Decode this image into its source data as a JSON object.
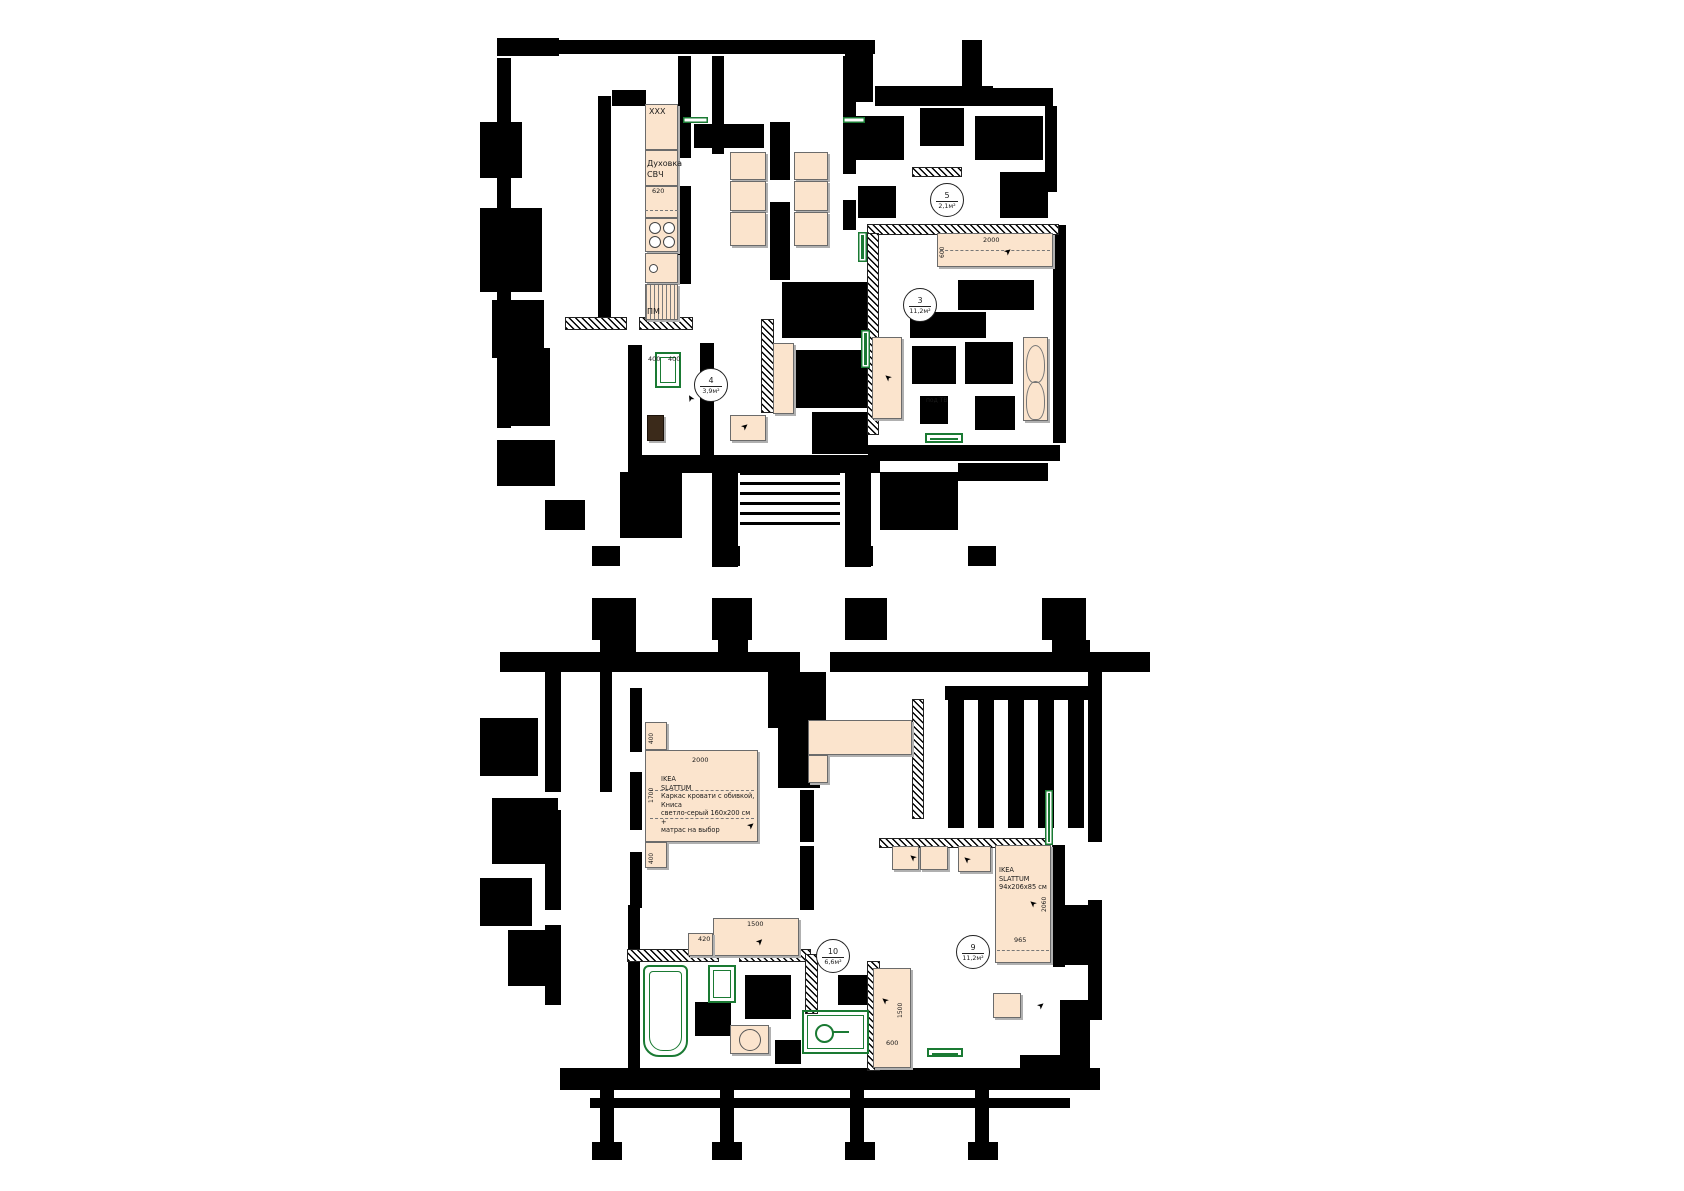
{
  "colors": {
    "wall": "#000000",
    "furniture_fill": "#fbe4cd",
    "furniture_border": "#6b6b6b",
    "green": "#1a7a33",
    "background": "#ffffff"
  },
  "kitchen": {
    "upper_cabinet": "XXX",
    "oven_line1": "Духовка",
    "oven_line2": "СВЧ",
    "counter_dim": "620",
    "dishwasher": "ПМ"
  },
  "room_markers": [
    {
      "n": "5",
      "a": "2,1м²",
      "x": 947,
      "y": 200
    },
    {
      "n": "3",
      "a": "11,2м²",
      "x": 920,
      "y": 305
    },
    {
      "n": "4",
      "a": "3,9м²",
      "x": 711,
      "y": 385
    },
    {
      "n": "10",
      "a": "6,6м²",
      "x": 833,
      "y": 956
    },
    {
      "n": "9",
      "a": "11,2м²",
      "x": 973,
      "y": 952
    }
  ],
  "labels": [
    {
      "t": "XXX",
      "x": 649,
      "y": 108,
      "s": 8
    },
    {
      "t": "Духовка",
      "x": 647,
      "y": 160,
      "s": 8
    },
    {
      "t": "СВЧ",
      "x": 647,
      "y": 171,
      "s": 8
    },
    {
      "t": "620",
      "x": 652,
      "y": 188,
      "s": 6.5
    },
    {
      "t": "ПМ",
      "x": 647,
      "y": 308,
      "s": 8
    },
    {
      "t": "400",
      "x": 648,
      "y": 356,
      "s": 6.5
    },
    {
      "t": "400",
      "x": 668,
      "y": 356,
      "s": 6.5
    },
    {
      "t": "2000",
      "x": 983,
      "y": 237,
      "s": 6.5
    },
    {
      "t": "600",
      "x": 940,
      "y": 258,
      "s": 6,
      "v": 1
    },
    {
      "t": "под ТВ",
      "x": 926,
      "y": 398,
      "s": 6
    },
    {
      "t": "2000",
      "x": 692,
      "y": 757,
      "s": 6.5
    },
    {
      "t": "1700",
      "x": 649,
      "y": 803,
      "s": 6,
      "v": 1
    },
    {
      "t": "400",
      "x": 649,
      "y": 744,
      "s": 5.8,
      "v": 1
    },
    {
      "t": "400",
      "x": 649,
      "y": 864,
      "s": 5.8,
      "v": 1
    },
    {
      "t": "1500",
      "x": 747,
      "y": 921,
      "s": 6.5
    },
    {
      "t": "420",
      "x": 698,
      "y": 936,
      "s": 6.5
    },
    {
      "t": "2060",
      "x": 1042,
      "y": 912,
      "s": 6,
      "v": 1
    },
    {
      "t": "965",
      "x": 1014,
      "y": 937,
      "s": 6.5
    },
    {
      "t": "1500",
      "x": 898,
      "y": 1018,
      "s": 6,
      "v": 1
    },
    {
      "t": "600",
      "x": 886,
      "y": 1040,
      "s": 6.5
    }
  ],
  "notes": [
    {
      "x": 661,
      "y": 775,
      "w": 95,
      "lines": [
        "IKEA",
        "SLATTUM",
        "Каркас кровати с обивкой, Книса",
        "светло-серый 160x200 см +",
        "матрас на выбор"
      ]
    },
    {
      "x": 999,
      "y": 866,
      "w": 52,
      "lines": [
        "IKEA",
        "SLATTUM",
        "94x206x85 см"
      ]
    }
  ],
  "furniture": [
    {
      "k": "cab",
      "n": "kitchen-upper-cabinet",
      "x": 645,
      "y": 104,
      "w": 33,
      "h": 46
    },
    {
      "k": "cab",
      "n": "kitchen-oven-cabinet",
      "x": 645,
      "y": 150,
      "w": 33,
      "h": 36
    },
    {
      "k": "cab",
      "n": "kitchen-counter",
      "x": 645,
      "y": 186,
      "w": 33,
      "h": 32
    },
    {
      "k": "stove",
      "n": "kitchen-stove",
      "x": 645,
      "y": 218,
      "w": 33,
      "h": 34
    },
    {
      "k": "sink",
      "n": "kitchen-sink",
      "x": 645,
      "y": 253,
      "w": 33,
      "h": 30
    },
    {
      "k": "dw",
      "n": "kitchen-dishwasher",
      "x": 645,
      "y": 284,
      "w": 33,
      "h": 36
    },
    {
      "k": "cab",
      "n": "dining-table-seat",
      "x": 730,
      "y": 152,
      "w": 36,
      "h": 28
    },
    {
      "k": "cab",
      "n": "dining-table-seat",
      "x": 730,
      "y": 181,
      "w": 36,
      "h": 30
    },
    {
      "k": "cab",
      "n": "dining-table-seat",
      "x": 730,
      "y": 212,
      "w": 36,
      "h": 34
    },
    {
      "k": "cab",
      "n": "dining-table-seat",
      "x": 794,
      "y": 152,
      "w": 34,
      "h": 28
    },
    {
      "k": "cab",
      "n": "dining-table-seat",
      "x": 794,
      "y": 181,
      "w": 34,
      "h": 30
    },
    {
      "k": "cab",
      "n": "dining-table-seat",
      "x": 794,
      "y": 212,
      "w": 34,
      "h": 34
    },
    {
      "k": "cab",
      "n": "bed-room3",
      "x": 937,
      "y": 233,
      "w": 116,
      "h": 34
    },
    {
      "k": "cab",
      "n": "wardrobe-room3",
      "x": 872,
      "y": 337,
      "w": 30,
      "h": 82
    },
    {
      "k": "armchair",
      "n": "armchair-room3",
      "x": 1023,
      "y": 337,
      "w": 25,
      "h": 84
    },
    {
      "k": "cab",
      "n": "hall-bench",
      "x": 730,
      "y": 415,
      "w": 36,
      "h": 26
    },
    {
      "k": "darkcab",
      "n": "hall-shoe-cabinet",
      "x": 647,
      "y": 415,
      "w": 17,
      "h": 26
    },
    {
      "k": "cab",
      "n": "hall-wardrobe",
      "x": 773,
      "y": 343,
      "w": 21,
      "h": 71
    },
    {
      "k": "cab",
      "n": "nightstand-top",
      "x": 645,
      "y": 722,
      "w": 22,
      "h": 28
    },
    {
      "k": "cab",
      "n": "bed-main",
      "x": 645,
      "y": 750,
      "w": 113,
      "h": 92
    },
    {
      "k": "cab",
      "n": "nightstand-bottom",
      "x": 645,
      "y": 842,
      "w": 22,
      "h": 26
    },
    {
      "k": "cab",
      "n": "corner-sofa-top",
      "x": 808,
      "y": 720,
      "w": 104,
      "h": 35
    },
    {
      "k": "cab",
      "n": "corner-sofa-side",
      "x": 808,
      "y": 755,
      "w": 20,
      "h": 28
    },
    {
      "k": "cab",
      "n": "room9-cabinet",
      "x": 892,
      "y": 846,
      "w": 27,
      "h": 24
    },
    {
      "k": "cab",
      "n": "room9-cabinet",
      "x": 920,
      "y": 846,
      "w": 28,
      "h": 24
    },
    {
      "k": "cab",
      "n": "room9-cabinet",
      "x": 958,
      "y": 846,
      "w": 33,
      "h": 26
    },
    {
      "k": "cab",
      "n": "bed-room9",
      "x": 995,
      "y": 845,
      "w": 56,
      "h": 118
    },
    {
      "k": "cab",
      "n": "nightstand-room9",
      "x": 993,
      "y": 993,
      "w": 28,
      "h": 25
    },
    {
      "k": "cab",
      "n": "wardrobe-room10",
      "x": 873,
      "y": 968,
      "w": 38,
      "h": 100
    },
    {
      "k": "cab",
      "n": "dresser",
      "x": 713,
      "y": 918,
      "w": 86,
      "h": 38
    },
    {
      "k": "cab",
      "n": "dresser-side",
      "x": 688,
      "y": 933,
      "w": 25,
      "h": 23
    },
    {
      "k": "washer",
      "n": "washing-machine",
      "x": 730,
      "y": 1025,
      "w": 39,
      "h": 29
    }
  ],
  "green": [
    {
      "k": "s",
      "n": "radiator",
      "x": 858,
      "y": 232,
      "w": 9,
      "h": 30
    },
    {
      "k": "s",
      "n": "radiator",
      "x": 861,
      "y": 330,
      "w": 9,
      "h": 38
    },
    {
      "k": "s",
      "n": "radiator",
      "x": 683,
      "y": 117,
      "w": 25,
      "h": 6
    },
    {
      "k": "s",
      "n": "radiator",
      "x": 843,
      "y": 117,
      "w": 22,
      "h": 6
    },
    {
      "k": "s",
      "n": "radiator",
      "x": 1045,
      "y": 790,
      "w": 8,
      "h": 55
    },
    {
      "k": "o",
      "n": "washer-dryer-hall",
      "x": 655,
      "y": 352,
      "w": 26,
      "h": 36
    },
    {
      "k": "o",
      "n": "tv-stand",
      "x": 925,
      "y": 433,
      "w": 38,
      "h": 10
    },
    {
      "k": "tub",
      "n": "bathtub",
      "x": 643,
      "y": 965,
      "w": 45,
      "h": 92
    },
    {
      "k": "o",
      "n": "bath-sink",
      "x": 708,
      "y": 965,
      "w": 28,
      "h": 38
    },
    {
      "k": "wc",
      "n": "toilet-zone",
      "x": 802,
      "y": 1010,
      "w": 67,
      "h": 44
    },
    {
      "k": "o",
      "n": "green-bench",
      "x": 927,
      "y": 1048,
      "w": 36,
      "h": 9
    }
  ],
  "walls": [
    [
      497,
      38,
      62,
      18
    ],
    [
      557,
      40,
      318,
      14
    ],
    [
      845,
      40,
      28,
      62
    ],
    [
      875,
      86,
      118,
      20
    ],
    [
      962,
      40,
      20,
      48
    ],
    [
      993,
      88,
      60,
      18
    ],
    [
      1045,
      106,
      12,
      86
    ],
    [
      497,
      58,
      14,
      370
    ],
    [
      480,
      122,
      42,
      56
    ],
    [
      480,
      208,
      62,
      84
    ],
    [
      492,
      300,
      52,
      58
    ],
    [
      506,
      348,
      44,
      78
    ],
    [
      598,
      96,
      13,
      232
    ],
    [
      612,
      90,
      34,
      16
    ],
    [
      678,
      56,
      13,
      48
    ],
    [
      678,
      100,
      13,
      58
    ],
    [
      678,
      186,
      13,
      98
    ],
    [
      712,
      56,
      12,
      98
    ],
    [
      694,
      124,
      70,
      24
    ],
    [
      770,
      122,
      20,
      58
    ],
    [
      770,
      202,
      20,
      78
    ],
    [
      843,
      56,
      13,
      118
    ],
    [
      843,
      200,
      13,
      30
    ],
    [
      850,
      116,
      54,
      44
    ],
    [
      920,
      108,
      44,
      38
    ],
    [
      975,
      116,
      68,
      44
    ],
    [
      1000,
      172,
      48,
      46
    ],
    [
      858,
      186,
      38,
      32
    ],
    [
      958,
      280,
      76,
      30
    ],
    [
      910,
      312,
      76,
      26
    ],
    [
      912,
      346,
      44,
      38
    ],
    [
      965,
      342,
      48,
      42
    ],
    [
      920,
      396,
      28,
      28
    ],
    [
      975,
      396,
      40,
      34
    ],
    [
      1053,
      225,
      13,
      218
    ],
    [
      868,
      445,
      192,
      16
    ],
    [
      628,
      345,
      14,
      112
    ],
    [
      700,
      343,
      14,
      118
    ],
    [
      628,
      455,
      252,
      18
    ],
    [
      712,
      455,
      26,
      112
    ],
    [
      845,
      455,
      26,
      112
    ],
    [
      620,
      472,
      62,
      66
    ],
    [
      545,
      500,
      40,
      30
    ],
    [
      497,
      440,
      58,
      46
    ],
    [
      880,
      472,
      78,
      58
    ],
    [
      958,
      463,
      90,
      18
    ],
    [
      592,
      546,
      28,
      20
    ],
    [
      712,
      546,
      28,
      20
    ],
    [
      845,
      546,
      28,
      20
    ],
    [
      968,
      546,
      28,
      20
    ],
    [
      782,
      282,
      86,
      56
    ],
    [
      795,
      350,
      74,
      58
    ],
    [
      812,
      412,
      56,
      42
    ],
    [
      592,
      598,
      44,
      42
    ],
    [
      712,
      598,
      40,
      42
    ],
    [
      845,
      598,
      42,
      42
    ],
    [
      1042,
      598,
      44,
      42
    ],
    [
      500,
      652,
      300,
      20
    ],
    [
      830,
      652,
      320,
      20
    ],
    [
      600,
      640,
      36,
      14
    ],
    [
      718,
      640,
      30,
      14
    ],
    [
      1052,
      640,
      38,
      14
    ],
    [
      768,
      672,
      58,
      56
    ],
    [
      778,
      728,
      42,
      60
    ],
    [
      800,
      790,
      14,
      52
    ],
    [
      800,
      846,
      14,
      64
    ],
    [
      545,
      672,
      16,
      120
    ],
    [
      545,
      810,
      16,
      100
    ],
    [
      545,
      925,
      16,
      80
    ],
    [
      480,
      718,
      58,
      58
    ],
    [
      492,
      798,
      66,
      66
    ],
    [
      480,
      878,
      52,
      48
    ],
    [
      508,
      930,
      48,
      56
    ],
    [
      600,
      672,
      12,
      120
    ],
    [
      630,
      688,
      12,
      64
    ],
    [
      630,
      772,
      12,
      58
    ],
    [
      630,
      852,
      12,
      56
    ],
    [
      945,
      686,
      150,
      14
    ],
    [
      948,
      700,
      16,
      128
    ],
    [
      978,
      700,
      16,
      128
    ],
    [
      1008,
      700,
      16,
      128
    ],
    [
      1038,
      700,
      16,
      128
    ],
    [
      1068,
      700,
      16,
      128
    ],
    [
      1088,
      672,
      14,
      170
    ],
    [
      1088,
      900,
      14,
      120
    ],
    [
      1052,
      905,
      40,
      60
    ],
    [
      1060,
      1000,
      30,
      60
    ],
    [
      1020,
      1055,
      70,
      26
    ],
    [
      1053,
      845,
      12,
      122
    ],
    [
      745,
      975,
      46,
      44
    ],
    [
      695,
      1002,
      36,
      34
    ],
    [
      775,
      1040,
      26,
      24
    ],
    [
      838,
      975,
      40,
      30
    ],
    [
      628,
      905,
      12,
      45
    ],
    [
      628,
      960,
      12,
      110
    ],
    [
      560,
      1068,
      540,
      22
    ],
    [
      590,
      1098,
      480,
      10
    ],
    [
      600,
      1090,
      14,
      52
    ],
    [
      720,
      1090,
      14,
      52
    ],
    [
      850,
      1090,
      14,
      52
    ],
    [
      975,
      1090,
      14,
      52
    ],
    [
      592,
      1142,
      30,
      18
    ],
    [
      712,
      1142,
      30,
      18
    ],
    [
      845,
      1142,
      30,
      18
    ],
    [
      968,
      1142,
      30,
      18
    ]
  ],
  "hatched": [
    [
      640,
      318,
      52,
      11
    ],
    [
      566,
      318,
      60,
      11
    ],
    [
      762,
      320,
      11,
      92
    ],
    [
      913,
      168,
      48,
      8
    ],
    [
      868,
      225,
      190,
      9
    ],
    [
      868,
      234,
      10,
      200
    ],
    [
      913,
      700,
      10,
      118
    ],
    [
      880,
      839,
      172,
      8
    ],
    [
      628,
      950,
      90,
      11
    ],
    [
      740,
      950,
      70,
      11
    ],
    [
      806,
      955,
      11,
      58
    ],
    [
      868,
      962,
      11,
      108
    ]
  ],
  "stairs": [
    [
      740,
      472,
      100,
      58
    ]
  ],
  "dashes": [
    [
      645,
      210,
      33
    ],
    [
      940,
      250,
      110
    ],
    [
      650,
      790,
      104
    ],
    [
      650,
      818,
      104
    ],
    [
      997,
      950,
      52
    ]
  ],
  "arrows": [
    [
      1005,
      248,
      -40
    ],
    [
      885,
      372,
      -140
    ],
    [
      748,
      822,
      -40
    ],
    [
      1030,
      898,
      -140
    ],
    [
      757,
      938,
      -45
    ],
    [
      1038,
      1002,
      -40
    ],
    [
      882,
      995,
      -140
    ],
    [
      910,
      852,
      -140
    ],
    [
      964,
      854,
      -140
    ],
    [
      688,
      393,
      -120
    ],
    [
      838,
      362,
      -60
    ],
    [
      742,
      423,
      -40
    ]
  ]
}
